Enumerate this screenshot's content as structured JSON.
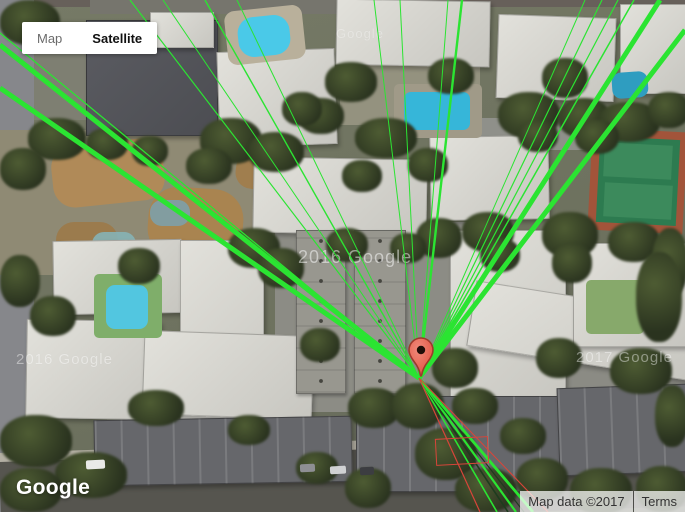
{
  "map_controls": {
    "map_label": "Map",
    "satellite_label": "Satellite"
  },
  "branding": {
    "logo_text": "Google"
  },
  "attribution": {
    "map_data_text": "Map data ©2017",
    "terms_text": "Terms"
  },
  "watermarks": [
    {
      "text": "Google",
      "x": 336,
      "y": 26,
      "size": 13,
      "opacity": 0.3
    },
    {
      "text": "2016 Google",
      "x": 298,
      "y": 247,
      "size": 18,
      "opacity": 0.5
    },
    {
      "text": "2016 Google",
      "x": 16,
      "y": 351,
      "size": 15,
      "opacity": 0.42
    },
    {
      "text": "2017 Google",
      "x": 576,
      "y": 349,
      "size": 15,
      "opacity": 0.42
    }
  ],
  "marker": {
    "tip_x": 421,
    "tip_y": 376,
    "body_color": "#f0897a",
    "body_dark": "#e04c3a",
    "outline_color": "#9c3a2c",
    "hole_color": "#200d08"
  },
  "overlay": {
    "origin": {
      "x": 419,
      "y": 378
    },
    "line_color_green": "#2be432",
    "line_color_dark": "#1e3c1e",
    "line_color_red": "#d8453a",
    "lines": [
      {
        "x": 0,
        "y": 45,
        "w": 5,
        "c": "green"
      },
      {
        "x": 0,
        "y": 88,
        "w": 5,
        "c": "green"
      },
      {
        "x": 0,
        "y": 33,
        "w": 1.3,
        "c": "green"
      },
      {
        "x": 130,
        "y": 0,
        "w": 1.2,
        "c": "green"
      },
      {
        "x": 163,
        "y": 0,
        "w": 1,
        "c": "green"
      },
      {
        "x": 205,
        "y": 0,
        "w": 1.4,
        "c": "green"
      },
      {
        "x": 237,
        "y": 0,
        "w": 1,
        "c": "green"
      },
      {
        "x": 374,
        "y": 0,
        "w": 1,
        "c": "green"
      },
      {
        "x": 400,
        "y": 0,
        "w": 1,
        "c": "green"
      },
      {
        "x": 448,
        "y": 0,
        "w": 1,
        "c": "green"
      },
      {
        "x": 462,
        "y": 0,
        "w": 2.4,
        "c": "green"
      },
      {
        "x": 585,
        "y": 0,
        "w": 1,
        "c": "green"
      },
      {
        "x": 602,
        "y": 0,
        "w": 1.2,
        "c": "green"
      },
      {
        "x": 618,
        "y": 0,
        "w": 1.2,
        "c": "green"
      },
      {
        "x": 634,
        "y": 0,
        "w": 1.5,
        "c": "green"
      },
      {
        "x": 660,
        "y": 0,
        "w": 5,
        "c": "green"
      },
      {
        "x": 685,
        "y": 30,
        "w": 5,
        "c": "green"
      },
      {
        "x": 497,
        "y": 512,
        "w": 1.6,
        "c": "green"
      },
      {
        "x": 508,
        "y": 512,
        "w": 1.6,
        "c": "dark"
      },
      {
        "x": 516,
        "y": 512,
        "w": 2.2,
        "c": "green"
      },
      {
        "x": 524,
        "y": 512,
        "w": 1.2,
        "c": "dark"
      },
      {
        "x": 533,
        "y": 512,
        "w": 2.8,
        "c": "green"
      },
      {
        "x": 480,
        "y": 512,
        "w": 1.2,
        "c": "red"
      },
      {
        "x": 548,
        "y": 512,
        "w": 1.1,
        "c": "red"
      }
    ],
    "red_outline": {
      "x": 436,
      "y": 438,
      "w": 52,
      "h": 26,
      "rot": -3
    }
  },
  "satellite": {
    "features": [
      {
        "cls": "plain",
        "x": 0,
        "y": 0,
        "w": 685,
        "h": 7,
        "c": "#67605a"
      },
      {
        "cls": "plain",
        "x": 90,
        "y": 0,
        "w": 255,
        "h": 14,
        "c": "#76756d"
      },
      {
        "cls": "plain",
        "x": 0,
        "y": 40,
        "w": 120,
        "h": 80,
        "c": "#7e7f72"
      },
      {
        "cls": "plain",
        "x": 0,
        "y": 0,
        "w": 34,
        "h": 512,
        "c": "#86878b"
      },
      {
        "cls": "plain",
        "x": 0,
        "y": 130,
        "w": 255,
        "h": 145,
        "c": "#8f8a74"
      },
      {
        "cls": "plain",
        "x": 275,
        "y": 222,
        "w": 210,
        "h": 190,
        "c": "#8c8c85"
      },
      {
        "cls": "plain",
        "x": 480,
        "y": 118,
        "w": 110,
        "h": 32,
        "c": "#8f908a"
      },
      {
        "cls": "plain",
        "x": 340,
        "y": 65,
        "w": 140,
        "h": 60,
        "c": "#94927f"
      },
      {
        "cls": "plain",
        "x": 560,
        "y": 350,
        "w": 125,
        "h": 45,
        "c": "#8b8b84"
      },
      {
        "cls": "plain",
        "x": 0,
        "y": 448,
        "w": 700,
        "h": 70,
        "c": "#56554f",
        "rot": -2
      },
      {
        "cls": "plain",
        "x": -5,
        "y": 441,
        "w": 700,
        "h": 9,
        "c": "#b3afa3",
        "rot": -2
      },
      {
        "cls": "plain",
        "x": 92,
        "y": 450,
        "w": 255,
        "h": 3,
        "c": "#9c4a3a",
        "rot": -1.5,
        "op": 0.75
      },
      {
        "cls": "plain",
        "x": 52,
        "y": 142,
        "w": 112,
        "h": 62,
        "c": "#b08a58",
        "rx": 22,
        "rot": -6
      },
      {
        "cls": "plain",
        "x": 148,
        "y": 188,
        "w": 95,
        "h": 72,
        "c": "#a98450",
        "rx": 30,
        "rot": 4
      },
      {
        "cls": "plain",
        "x": 56,
        "y": 222,
        "w": 62,
        "h": 46,
        "c": "#9b7b4d",
        "rx": 18
      },
      {
        "cls": "plain",
        "x": 236,
        "y": 150,
        "w": 50,
        "h": 40,
        "c": "#a07e4e",
        "rx": 16,
        "rot": 8
      },
      {
        "cls": "plain",
        "x": 150,
        "y": 200,
        "w": 40,
        "h": 26,
        "c": "#7da0a8",
        "rx": 12,
        "op": 0.9
      },
      {
        "cls": "plain",
        "x": 92,
        "y": 232,
        "w": 44,
        "h": 30,
        "c": "#86b2b6",
        "rx": 12,
        "op": 0.9
      },
      {
        "cls": "dark",
        "x": 86,
        "y": 20,
        "w": 130,
        "h": 114
      },
      {
        "cls": "bld",
        "x": 150,
        "y": 12,
        "w": 62,
        "h": 34
      },
      {
        "cls": "bld",
        "x": 218,
        "y": 50,
        "w": 116,
        "h": 94,
        "rot": -2
      },
      {
        "cls": "bld",
        "x": 336,
        "y": 0,
        "w": 152,
        "h": 64,
        "rot": 1
      },
      {
        "cls": "bld",
        "x": 497,
        "y": 16,
        "w": 116,
        "h": 82,
        "rot": 2
      },
      {
        "cls": "bld",
        "x": 620,
        "y": 4,
        "w": 66,
        "h": 88
      },
      {
        "cls": "bld",
        "x": 253,
        "y": 158,
        "w": 172,
        "h": 74,
        "rot": 1
      },
      {
        "cls": "bld",
        "x": 430,
        "y": 136,
        "w": 117,
        "h": 82,
        "rot": -1
      },
      {
        "cls": "bld",
        "x": 53,
        "y": 240,
        "w": 127,
        "h": 72,
        "rot": -1
      },
      {
        "cls": "bld",
        "x": 180,
        "y": 240,
        "w": 82,
        "h": 182
      },
      {
        "cls": "bld",
        "x": 450,
        "y": 230,
        "w": 114,
        "h": 172
      },
      {
        "cls": "bld",
        "x": 470,
        "y": 298,
        "w": 228,
        "h": 64,
        "rot": 9
      },
      {
        "cls": "bld",
        "x": 573,
        "y": 243,
        "w": 112,
        "h": 102
      },
      {
        "cls": "bld",
        "x": 26,
        "y": 320,
        "w": 132,
        "h": 97,
        "rot": 1
      },
      {
        "cls": "bld",
        "x": 143,
        "y": 333,
        "w": 168,
        "h": 82,
        "rot": 2
      },
      {
        "cls": "plain",
        "x": 590,
        "y": 130,
        "w": 95,
        "h": 102,
        "c": "#a2543a",
        "rot": 3
      },
      {
        "cls": "plain",
        "x": 598,
        "y": 138,
        "w": 80,
        "h": 86,
        "c": "#2d7b50",
        "rot": 3
      },
      {
        "cls": "plain",
        "x": 604,
        "y": 144,
        "w": 68,
        "h": 34,
        "c": "#3c8a5c",
        "rot": 3
      },
      {
        "cls": "plain",
        "x": 604,
        "y": 184,
        "w": 68,
        "h": 34,
        "c": "#3c8a5c",
        "rot": 3
      },
      {
        "cls": "plain",
        "x": 226,
        "y": 8,
        "w": 78,
        "h": 54,
        "c": "#b9b09b",
        "rx": 10,
        "rot": -6
      },
      {
        "cls": "plain",
        "x": 238,
        "y": 16,
        "w": 52,
        "h": 40,
        "c": "#4ac9e8",
        "rx": 16,
        "rot": -6
      },
      {
        "cls": "plain",
        "x": 394,
        "y": 84,
        "w": 88,
        "h": 54,
        "c": "#a09a88",
        "rx": 5
      },
      {
        "cls": "plain",
        "x": 404,
        "y": 92,
        "w": 66,
        "h": 38,
        "c": "#36b6d9",
        "rx": 7
      },
      {
        "cls": "plain",
        "x": 94,
        "y": 274,
        "w": 68,
        "h": 64,
        "c": "#7fae6a",
        "rx": 5
      },
      {
        "cls": "plain",
        "x": 106,
        "y": 285,
        "w": 42,
        "h": 44,
        "c": "#52c6e0",
        "rx": 9
      },
      {
        "cls": "plain",
        "x": 612,
        "y": 72,
        "w": 36,
        "h": 26,
        "c": "#2f9dc0",
        "rx": 9,
        "rot": -4
      },
      {
        "cls": "plain",
        "x": 586,
        "y": 280,
        "w": 58,
        "h": 54,
        "c": "#87a96b",
        "rx": 5
      },
      {
        "cls": "garage",
        "x": 94,
        "y": 418,
        "w": 256,
        "h": 64,
        "rot": -1
      },
      {
        "cls": "garage",
        "x": 356,
        "y": 396,
        "w": 202,
        "h": 94
      },
      {
        "cls": "garage",
        "x": 558,
        "y": 386,
        "w": 128,
        "h": 86,
        "rot": -2
      },
      {
        "cls": "garage2",
        "x": 296,
        "y": 230,
        "w": 48,
        "h": 162
      },
      {
        "cls": "garage2",
        "x": 354,
        "y": 230,
        "w": 50,
        "h": 162
      },
      {
        "cls": "tree",
        "x": 28,
        "y": 118,
        "w": 58,
        "h": 42
      },
      {
        "cls": "tree",
        "x": 0,
        "y": 148,
        "w": 46,
        "h": 42
      },
      {
        "cls": "tree",
        "x": 200,
        "y": 118,
        "w": 62,
        "h": 46
      },
      {
        "cls": "tree",
        "x": 248,
        "y": 132,
        "w": 56,
        "h": 40
      },
      {
        "cls": "tree",
        "x": 118,
        "y": 248,
        "w": 42,
        "h": 36
      },
      {
        "cls": "tree",
        "x": 228,
        "y": 228,
        "w": 52,
        "h": 40
      },
      {
        "cls": "tree",
        "x": 258,
        "y": 248,
        "w": 46,
        "h": 40
      },
      {
        "cls": "tree",
        "x": 325,
        "y": 62,
        "w": 52,
        "h": 40
      },
      {
        "cls": "tree",
        "x": 298,
        "y": 98,
        "w": 46,
        "h": 36
      },
      {
        "cls": "tree",
        "x": 355,
        "y": 118,
        "w": 62,
        "h": 40
      },
      {
        "cls": "tree",
        "x": 428,
        "y": 58,
        "w": 46,
        "h": 36
      },
      {
        "cls": "tree",
        "x": 498,
        "y": 92,
        "w": 62,
        "h": 46
      },
      {
        "cls": "tree",
        "x": 542,
        "y": 58,
        "w": 46,
        "h": 40
      },
      {
        "cls": "tree",
        "x": 558,
        "y": 98,
        "w": 52,
        "h": 40
      },
      {
        "cls": "tree",
        "x": 598,
        "y": 102,
        "w": 62,
        "h": 40
      },
      {
        "cls": "tree",
        "x": 648,
        "y": 92,
        "w": 42,
        "h": 36
      },
      {
        "cls": "tree",
        "x": 542,
        "y": 212,
        "w": 56,
        "h": 46
      },
      {
        "cls": "tree",
        "x": 608,
        "y": 222,
        "w": 52,
        "h": 40
      },
      {
        "cls": "tree",
        "x": 652,
        "y": 228,
        "w": 36,
        "h": 70
      },
      {
        "cls": "tree",
        "x": 636,
        "y": 252,
        "w": 46,
        "h": 90
      },
      {
        "cls": "tree",
        "x": 552,
        "y": 243,
        "w": 40,
        "h": 40
      },
      {
        "cls": "tree",
        "x": 416,
        "y": 218,
        "w": 46,
        "h": 40
      },
      {
        "cls": "tree",
        "x": 408,
        "y": 148,
        "w": 40,
        "h": 34
      },
      {
        "cls": "tree",
        "x": 462,
        "y": 212,
        "w": 52,
        "h": 40
      },
      {
        "cls": "tree",
        "x": 0,
        "y": 255,
        "w": 40,
        "h": 52
      },
      {
        "cls": "tree",
        "x": 30,
        "y": 296,
        "w": 46,
        "h": 40
      },
      {
        "cls": "tree",
        "x": 0,
        "y": 415,
        "w": 72,
        "h": 52
      },
      {
        "cls": "tree",
        "x": 55,
        "y": 452,
        "w": 72,
        "h": 46
      },
      {
        "cls": "tree",
        "x": 0,
        "y": 468,
        "w": 62,
        "h": 44
      },
      {
        "cls": "tree",
        "x": 128,
        "y": 390,
        "w": 56,
        "h": 36
      },
      {
        "cls": "tree",
        "x": 228,
        "y": 415,
        "w": 42,
        "h": 30
      },
      {
        "cls": "tree",
        "x": 348,
        "y": 388,
        "w": 52,
        "h": 40
      },
      {
        "cls": "tree",
        "x": 415,
        "y": 428,
        "w": 62,
        "h": 52
      },
      {
        "cls": "tree",
        "x": 455,
        "y": 468,
        "w": 62,
        "h": 44
      },
      {
        "cls": "tree",
        "x": 516,
        "y": 458,
        "w": 52,
        "h": 42
      },
      {
        "cls": "tree",
        "x": 345,
        "y": 468,
        "w": 46,
        "h": 40
      },
      {
        "cls": "tree",
        "x": 296,
        "y": 452,
        "w": 42,
        "h": 32
      },
      {
        "cls": "tree",
        "x": 570,
        "y": 468,
        "w": 62,
        "h": 46
      },
      {
        "cls": "tree",
        "x": 636,
        "y": 466,
        "w": 52,
        "h": 46
      },
      {
        "cls": "tree",
        "x": 610,
        "y": 348,
        "w": 62,
        "h": 46
      },
      {
        "cls": "tree",
        "x": 655,
        "y": 385,
        "w": 34,
        "h": 62
      },
      {
        "cls": "tree",
        "x": 536,
        "y": 338,
        "w": 46,
        "h": 40
      },
      {
        "cls": "tree",
        "x": 500,
        "y": 418,
        "w": 46,
        "h": 36
      },
      {
        "cls": "tree",
        "x": 186,
        "y": 148,
        "w": 46,
        "h": 36
      },
      {
        "cls": "tree",
        "x": 86,
        "y": 128,
        "w": 42,
        "h": 32
      },
      {
        "cls": "tree",
        "x": 326,
        "y": 228,
        "w": 42,
        "h": 34
      },
      {
        "cls": "tree",
        "x": 390,
        "y": 233,
        "w": 36,
        "h": 30
      },
      {
        "cls": "tree",
        "x": 432,
        "y": 348,
        "w": 46,
        "h": 40
      },
      {
        "cls": "tree",
        "x": 392,
        "y": 383,
        "w": 52,
        "h": 46
      },
      {
        "cls": "tree",
        "x": 452,
        "y": 388,
        "w": 46,
        "h": 36
      },
      {
        "cls": "tree",
        "x": 300,
        "y": 328,
        "w": 40,
        "h": 34
      },
      {
        "cls": "tree",
        "x": 342,
        "y": 160,
        "w": 40,
        "h": 32
      },
      {
        "cls": "tree",
        "x": 282,
        "y": 92,
        "w": 40,
        "h": 34
      },
      {
        "cls": "tree",
        "x": 132,
        "y": 136,
        "w": 36,
        "h": 30
      },
      {
        "cls": "tree",
        "x": 480,
        "y": 238,
        "w": 40,
        "h": 34
      },
      {
        "cls": "tree",
        "x": 518,
        "y": 120,
        "w": 40,
        "h": 32
      },
      {
        "cls": "tree",
        "x": 575,
        "y": 120,
        "w": 44,
        "h": 34
      },
      {
        "cls": "tree",
        "x": 0,
        "y": 0,
        "w": 60,
        "h": 45
      },
      {
        "cls": "plain",
        "x": 86,
        "y": 460,
        "w": 19,
        "h": 9,
        "c": "#e9e9e7",
        "rot": -3,
        "rx": 2
      },
      {
        "cls": "plain",
        "x": 300,
        "y": 464,
        "w": 15,
        "h": 8,
        "c": "#8e8f93",
        "rot": -3,
        "rx": 2
      },
      {
        "cls": "plain",
        "x": 330,
        "y": 466,
        "w": 16,
        "h": 8,
        "c": "#d0d1d3",
        "rot": -3,
        "rx": 2
      },
      {
        "cls": "plain",
        "x": 360,
        "y": 467,
        "w": 14,
        "h": 8,
        "c": "#3c3d41",
        "rot": -3,
        "rx": 2
      }
    ]
  }
}
